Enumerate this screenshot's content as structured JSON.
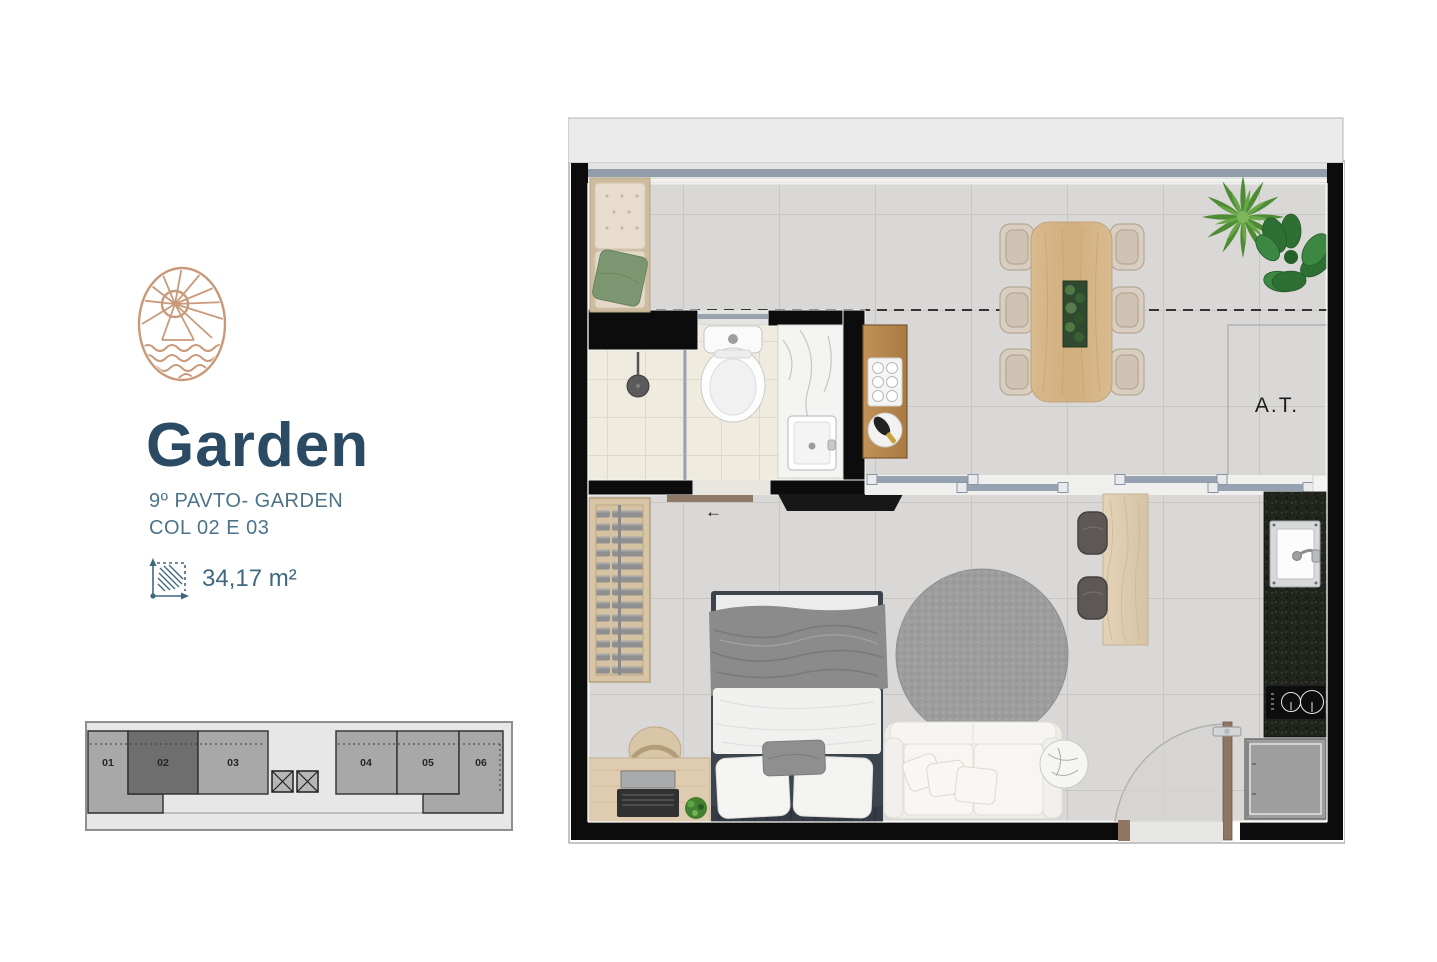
{
  "unit_info": {
    "title": "Garden",
    "subtitle_line1": "9º PAVTO- GARDEN",
    "subtitle_line2": "COL 02 E 03",
    "area": "34,17 m²"
  },
  "floor_plan": {
    "technical_area_label": "A.T.",
    "door_direction_arrow": "←"
  },
  "key_plan": {
    "highlighted_unit": "02",
    "units": [
      {
        "label": "01"
      },
      {
        "label": "02"
      },
      {
        "label": "03"
      },
      {
        "label": "04"
      },
      {
        "label": "05"
      },
      {
        "label": "06"
      }
    ]
  },
  "colors": {
    "brand_logo": "#c9997a",
    "title_text": "#2b4a63",
    "subtitle_text": "#4c7389",
    "area_text": "#3f6880",
    "wall": "#0c0c0c",
    "floor_tile": "#d9d8d6",
    "bath_tile": "#efecdf",
    "window_track": "#96a1b1",
    "kitchen_counter": "#20241d",
    "wood": "#d8b98b",
    "unit_fill": "#a8a8a8",
    "highlighted_unit_fill": "#6e6e6e"
  }
}
